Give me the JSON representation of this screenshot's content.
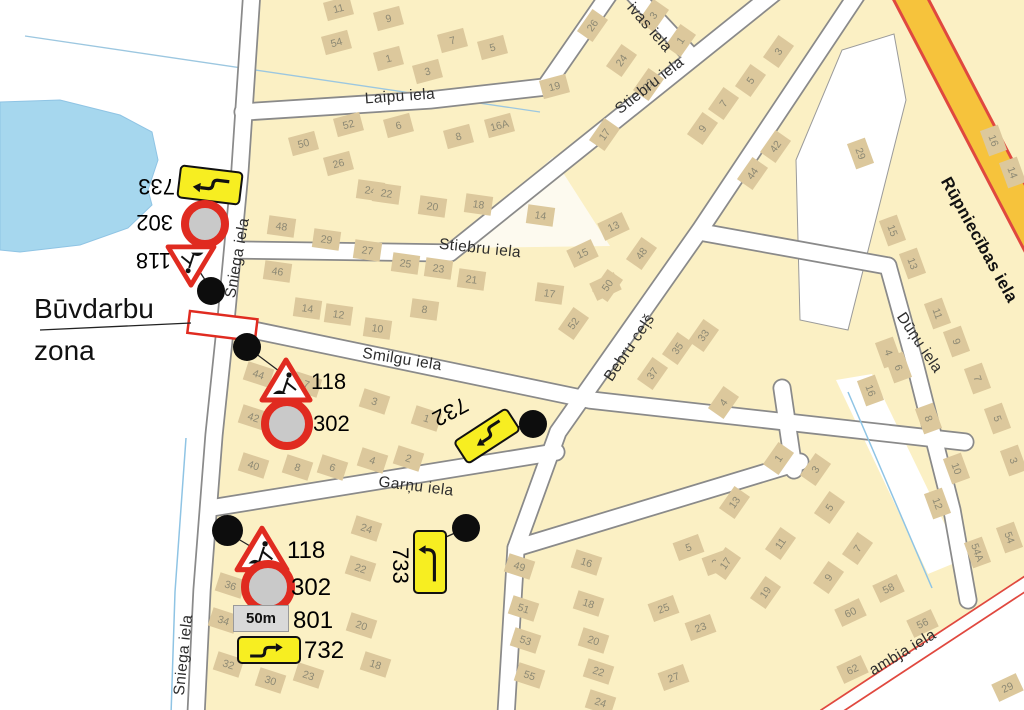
{
  "map": {
    "construction_zone": {
      "line1": "Būvdarbu",
      "line2": "zona"
    },
    "street_labels": [
      {
        "text": "Sniega iela",
        "x": 238,
        "y": 258,
        "rot": -80
      },
      {
        "text": "Sniega iela",
        "x": 184,
        "y": 655,
        "rot": -84
      },
      {
        "text": "Laipu iela",
        "x": 400,
        "y": 97,
        "rot": -4
      },
      {
        "text": "Stiebru iela",
        "x": 480,
        "y": 249,
        "rot": 6
      },
      {
        "text": "Stiebru iela",
        "x": 650,
        "y": 86,
        "rot": -38
      },
      {
        "text": "ivas iela",
        "x": 649,
        "y": 28,
        "rot": 49
      },
      {
        "text": "Smilgu iela",
        "x": 402,
        "y": 360,
        "rot": 9
      },
      {
        "text": "Garņu iela",
        "x": 416,
        "y": 487,
        "rot": 7
      },
      {
        "text": "Bebru ceļš",
        "x": 630,
        "y": 348,
        "rot": -56
      },
      {
        "text": "Dūņu iela",
        "x": 919,
        "y": 343,
        "rot": 56
      },
      {
        "text": "Rūpniecības iela",
        "x": 979,
        "y": 240,
        "rot": 61,
        "bold": true
      },
      {
        "text": "ambja iela",
        "x": 903,
        "y": 653,
        "rot": -31
      }
    ],
    "signs": {
      "top_cluster": {
        "s733": "733",
        "s302": "302",
        "s118": "118"
      },
      "mid_cluster": {
        "s118": "118",
        "s302": "302"
      },
      "mid_detour": {
        "s732": "732"
      },
      "bottom_cluster": {
        "s118": "118",
        "s302": "302",
        "s801": "801",
        "s732": "732",
        "plate": "50m"
      },
      "bottom_detour": {
        "s733": "733"
      }
    },
    "buildings": [
      [
        "11",
        338,
        8,
        -15
      ],
      [
        "9",
        388,
        18,
        -15
      ],
      [
        "54",
        336,
        42,
        -15
      ],
      [
        "1",
        388,
        58,
        -15
      ],
      [
        "7",
        452,
        40,
        -15
      ],
      [
        "5",
        492,
        47,
        -15
      ],
      [
        "3",
        427,
        71,
        -15
      ],
      [
        "52",
        348,
        124,
        -15
      ],
      [
        "6",
        398,
        125,
        -15
      ],
      [
        "8",
        458,
        136,
        -15
      ],
      [
        "50",
        303,
        143,
        -15
      ],
      [
        "26",
        338,
        163,
        -15
      ],
      [
        "16A",
        499,
        125,
        -15
      ],
      [
        "19",
        554,
        86,
        -15
      ],
      [
        "20",
        432,
        206,
        8
      ],
      [
        "18",
        478,
        204,
        8
      ],
      [
        "14",
        540,
        215,
        8
      ],
      [
        "24",
        370,
        190,
        8
      ],
      [
        "22",
        386,
        193,
        8
      ],
      [
        "48",
        281,
        226,
        8
      ],
      [
        "29",
        326,
        239,
        8
      ],
      [
        "27",
        367,
        250,
        8
      ],
      [
        "25",
        405,
        263,
        8
      ],
      [
        "46",
        277,
        271,
        8
      ],
      [
        "23",
        438,
        268,
        8
      ],
      [
        "21",
        471,
        279,
        8
      ],
      [
        "14",
        307,
        308,
        8
      ],
      [
        "12",
        338,
        314,
        8
      ],
      [
        "10",
        377,
        328,
        8
      ],
      [
        "8",
        424,
        309,
        8
      ],
      [
        "15",
        582,
        253,
        -25
      ],
      [
        "13",
        613,
        226,
        -25
      ],
      [
        "17",
        549,
        293,
        8
      ],
      [
        "50",
        605,
        286,
        -25
      ],
      [
        "26",
        592,
        25,
        -55
      ],
      [
        "3",
        653,
        15,
        -55
      ],
      [
        "1",
        680,
        40,
        -55
      ],
      [
        "24",
        621,
        60,
        -55
      ],
      [
        "22",
        648,
        84,
        -55
      ],
      [
        "17",
        604,
        134,
        -55
      ],
      [
        "5",
        750,
        80,
        -55
      ],
      [
        "3",
        778,
        51,
        -55
      ],
      [
        "7",
        723,
        103,
        -55
      ],
      [
        "9",
        702,
        128,
        -55
      ],
      [
        "42",
        775,
        146,
        -55
      ],
      [
        "44",
        752,
        173,
        -55
      ],
      [
        "48",
        641,
        253,
        -55
      ],
      [
        "50",
        607,
        285,
        -55
      ],
      [
        "52",
        573,
        323,
        -55
      ],
      [
        "33",
        703,
        335,
        -55
      ],
      [
        "35",
        677,
        348,
        -55
      ],
      [
        "37",
        652,
        373,
        -55
      ],
      [
        "44",
        258,
        374,
        18
      ],
      [
        "42",
        253,
        417,
        18
      ],
      [
        "40",
        253,
        465,
        18
      ],
      [
        "8",
        297,
        467,
        18
      ],
      [
        "6",
        332,
        467,
        18
      ],
      [
        "4",
        372,
        460,
        18
      ],
      [
        "2",
        408,
        458,
        18
      ],
      [
        "3",
        374,
        401,
        18
      ],
      [
        "1",
        426,
        418,
        18
      ],
      [
        "7",
        306,
        384,
        18
      ],
      [
        "36",
        230,
        585,
        18
      ],
      [
        "34",
        223,
        620,
        18
      ],
      [
        "32",
        228,
        664,
        18
      ],
      [
        "30",
        270,
        680,
        18
      ],
      [
        "23",
        308,
        675,
        18
      ],
      [
        "24",
        366,
        528,
        18
      ],
      [
        "22",
        360,
        568,
        18
      ],
      [
        "20",
        361,
        625,
        18
      ],
      [
        "18",
        375,
        664,
        18
      ],
      [
        "49",
        519,
        566,
        18
      ],
      [
        "51",
        523,
        608,
        18
      ],
      [
        "53",
        525,
        640,
        18
      ],
      [
        "55",
        529,
        675,
        18
      ],
      [
        "16",
        586,
        562,
        18
      ],
      [
        "18",
        588,
        603,
        18
      ],
      [
        "20",
        593,
        640,
        18
      ],
      [
        "22",
        598,
        671,
        18
      ],
      [
        "24",
        600,
        702,
        18
      ],
      [
        "25",
        663,
        608,
        -20
      ],
      [
        "23",
        700,
        627,
        -20
      ],
      [
        "27",
        673,
        677,
        -20
      ],
      [
        "5",
        688,
        547,
        -20
      ],
      [
        "21",
        717,
        562,
        -20
      ],
      [
        "4",
        723,
        402,
        -55
      ],
      [
        "13",
        734,
        502,
        -55
      ],
      [
        "11",
        780,
        543,
        -55
      ],
      [
        "17",
        725,
        563,
        -55
      ],
      [
        "19",
        765,
        592,
        -55
      ],
      [
        "1",
        778,
        458,
        -55
      ],
      [
        "3",
        815,
        469,
        -55
      ],
      [
        "5",
        829,
        507,
        -55
      ],
      [
        "7",
        857,
        548,
        -55
      ],
      [
        "9",
        828,
        577,
        -55
      ],
      [
        "16",
        870,
        390,
        70
      ],
      [
        "8",
        928,
        418,
        70
      ],
      [
        "10",
        956,
        468,
        70
      ],
      [
        "12",
        937,
        503,
        70
      ],
      [
        "54",
        1009,
        537,
        70
      ],
      [
        "54A",
        977,
        552,
        70
      ],
      [
        "3",
        1013,
        460,
        70
      ],
      [
        "5",
        997,
        418,
        70
      ],
      [
        "11",
        937,
        313,
        70
      ],
      [
        "9",
        956,
        341,
        70
      ],
      [
        "7",
        977,
        378,
        70
      ],
      [
        "4",
        888,
        352,
        70
      ],
      [
        "6",
        898,
        367,
        70
      ],
      [
        "29",
        860,
        153,
        70
      ],
      [
        "16",
        993,
        140,
        70
      ],
      [
        "14",
        1012,
        172,
        70
      ],
      [
        "15",
        892,
        230,
        70
      ],
      [
        "13",
        912,
        263,
        70
      ],
      [
        "58",
        888,
        588,
        -25
      ],
      [
        "60",
        850,
        612,
        -25
      ],
      [
        "56",
        922,
        623,
        -25
      ],
      [
        "62",
        852,
        669,
        -25
      ],
      [
        "29",
        1007,
        687,
        -25
      ]
    ],
    "colors": {
      "block_yellow": "#fbf0c4",
      "building_tan": "#dcc89c",
      "water_blue": "#a6d7ee",
      "road_orange": "#f6c33c",
      "road_red_casing": "#e0483f",
      "sign_red": "#e02b20",
      "sign_yellow": "#f7ee21"
    }
  }
}
